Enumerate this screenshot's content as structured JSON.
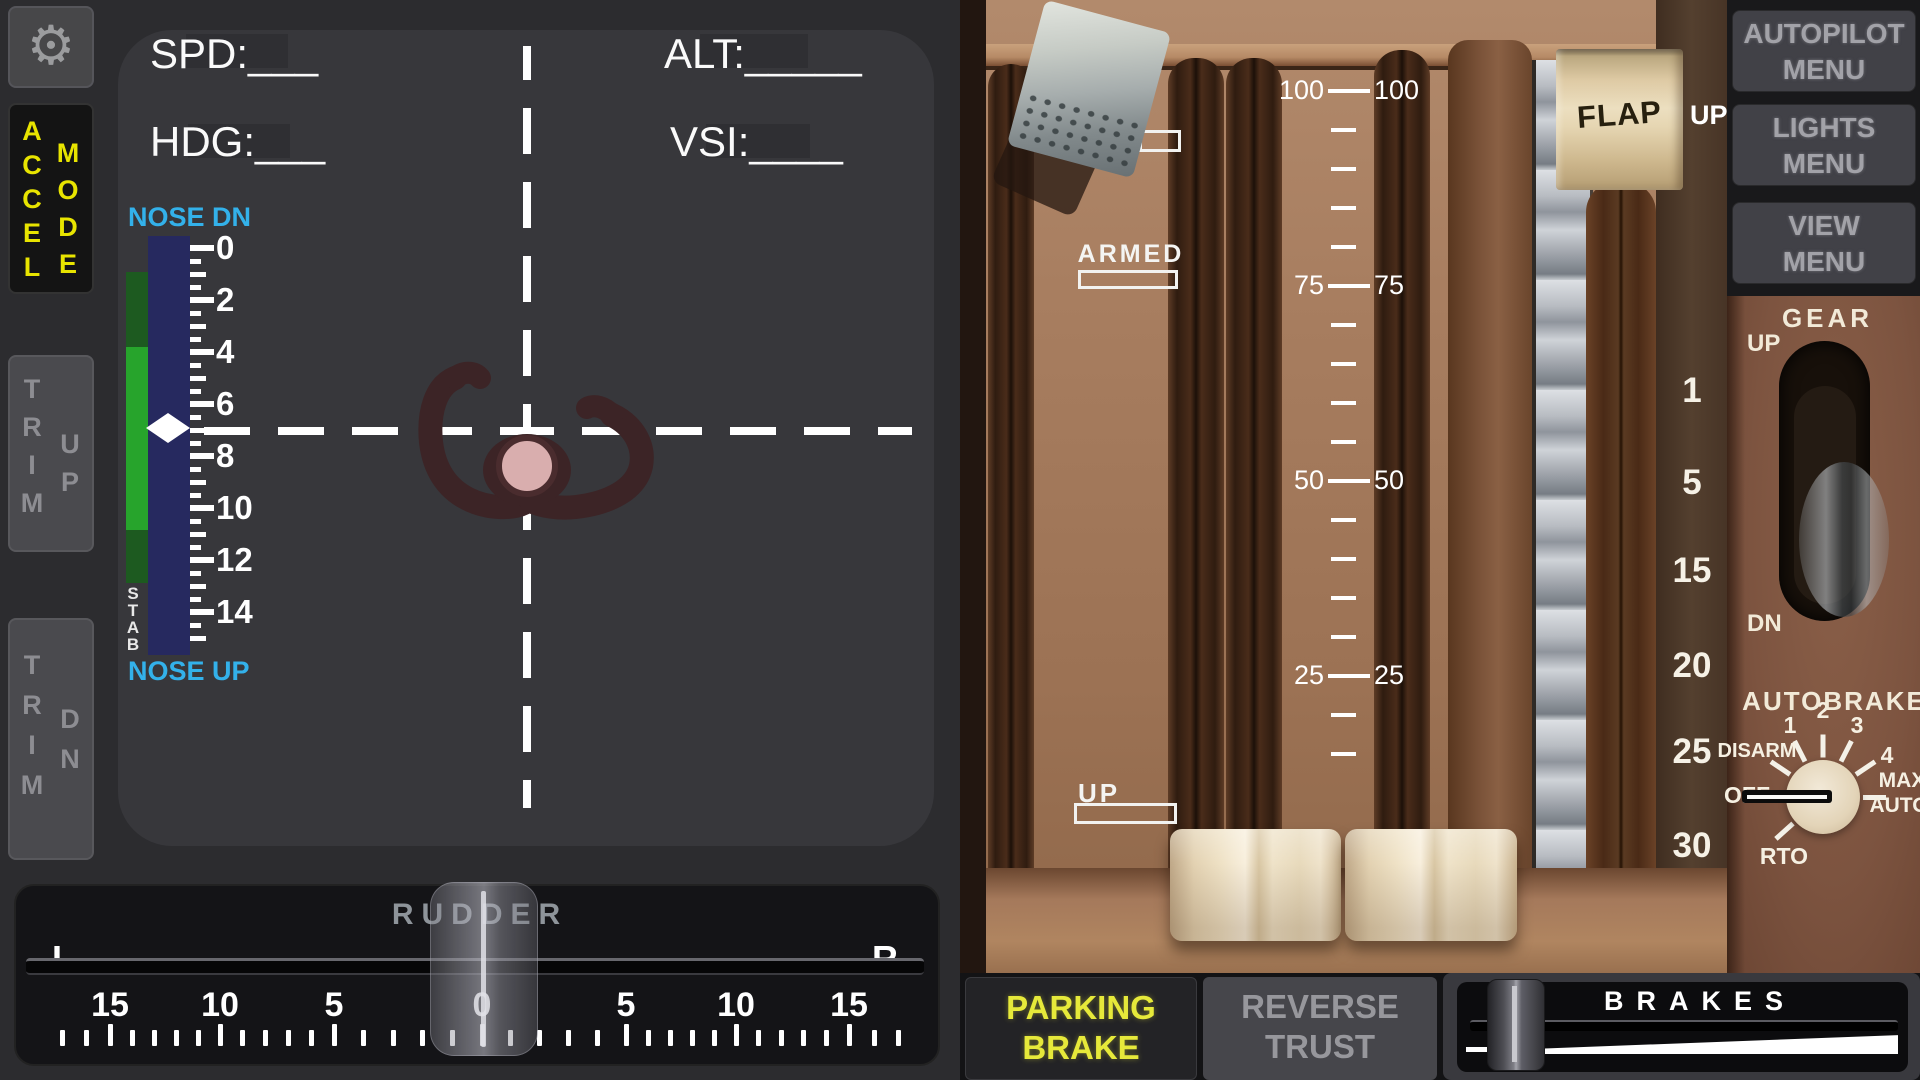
{
  "left": {
    "readouts": {
      "spd": "SPD:___",
      "alt": "ALT:_____",
      "hdg": "HDG:___",
      "vsi": "VSI:____"
    },
    "trim": {
      "nose_dn": "NOSE DN",
      "nose_up": "NOSE UP",
      "stab": "STAB",
      "scale_labels": [
        "0",
        "2",
        "4",
        "6",
        "8",
        "10",
        "12",
        "14"
      ]
    },
    "buttons": {
      "accel": "ACCEL",
      "mode": "MODE",
      "trim": "TRIM",
      "up": "UP",
      "dn": "DN"
    },
    "rudder": {
      "title": "RUDDER",
      "left_label": "L",
      "right_label": "R",
      "numbers": [
        "15",
        "10",
        "5",
        "0",
        "5",
        "10",
        "15"
      ]
    }
  },
  "right": {
    "menus": [
      {
        "line1": "AUTOPILOT",
        "line2": "MENU"
      },
      {
        "line1": "LIGHTS",
        "line2": "MENU"
      },
      {
        "line1": "VIEW",
        "line2": "MENU"
      }
    ],
    "flap": {
      "label": "FLAP",
      "position": "UP"
    },
    "speedbrake": {
      "armed": "ARMED",
      "up_label": "UP",
      "scale": [
        "100",
        "75",
        "50",
        "25"
      ]
    },
    "gear": {
      "title": "GEAR",
      "up": "UP",
      "dn": "DN"
    },
    "flap_detents": [
      "1",
      "5",
      "15",
      "20",
      "25",
      "30"
    ],
    "autobrake": {
      "title": "AUTOBRAKE",
      "labels": [
        "DISARM",
        "1",
        "2",
        "3",
        "4",
        "MAX",
        "AUTO",
        "OFF",
        "RTO"
      ]
    },
    "bottom": {
      "parking_line1": "PARKING",
      "parking_line2": "BRAKE",
      "reverse_line1": "REVERSE",
      "reverse_line2": "TRUST",
      "brakes": "BRAKES"
    }
  },
  "icons": {
    "gear": "⚙"
  },
  "colors": {
    "accent_yellow": "#e8e400",
    "cyan": "#33b1ea",
    "trim_green": "#27a42c",
    "trim_navy": "#26295f",
    "parking_yellow": "#e6e93a",
    "panel_gray": "#37373b"
  }
}
